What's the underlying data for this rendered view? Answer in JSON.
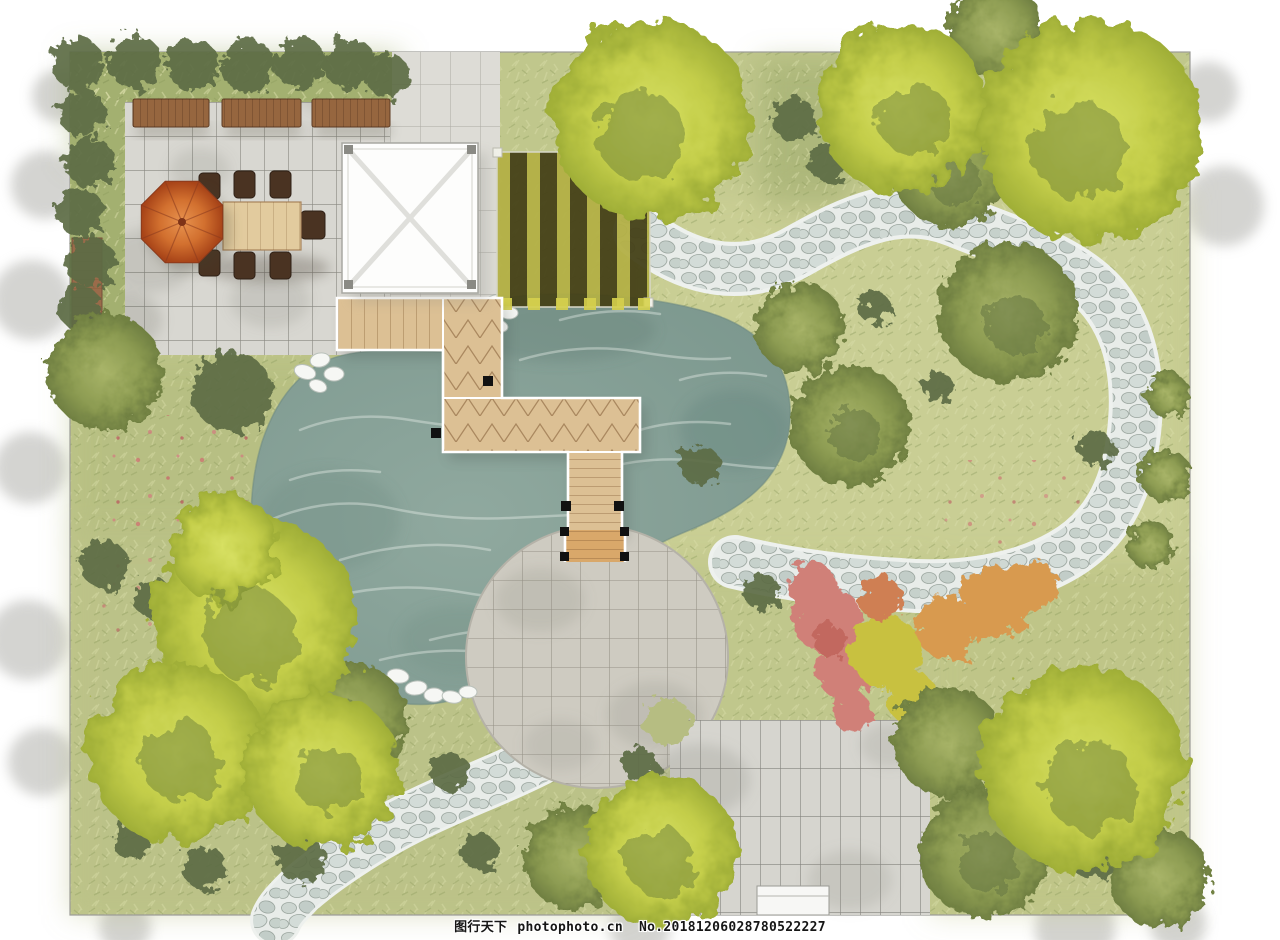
{
  "meta": {
    "width": 1280,
    "height": 940
  },
  "watermark": {
    "site_name": "图行天下",
    "site_url": "photophoto.cn",
    "serial_number": "No.20181206028780522227"
  },
  "palette": {
    "background": "#ffffff",
    "grass_base": "#c0c78c",
    "pond_water": "#87a096",
    "pebble_bed": "#eef1ee",
    "stone_tile": "#d8d7d1",
    "plaza_stone": "#cecbc1",
    "pad_stone": "#d6d5cf",
    "deck_wood": "#dcc094",
    "bridge_wood": "#d9a86a",
    "bench_wood": "#96663f",
    "table_wood": "#e2cb9e",
    "chair_wood": "#4a3322",
    "umbrella_orange": "#c75f2e",
    "pergola_white": "#fdfdfc",
    "stripe_dark": "#454118",
    "stripe_yellow": "#b3b046",
    "tree_lime": "#c3cd49",
    "tree_olive": "#8d9c52",
    "shrub_dark": "#5d6c45",
    "shrub_pink": "#d08078",
    "shrub_orange": "#d89a50",
    "shrub_yellow": "#c8c140",
    "rock_white": "#f6f7f4"
  }
}
